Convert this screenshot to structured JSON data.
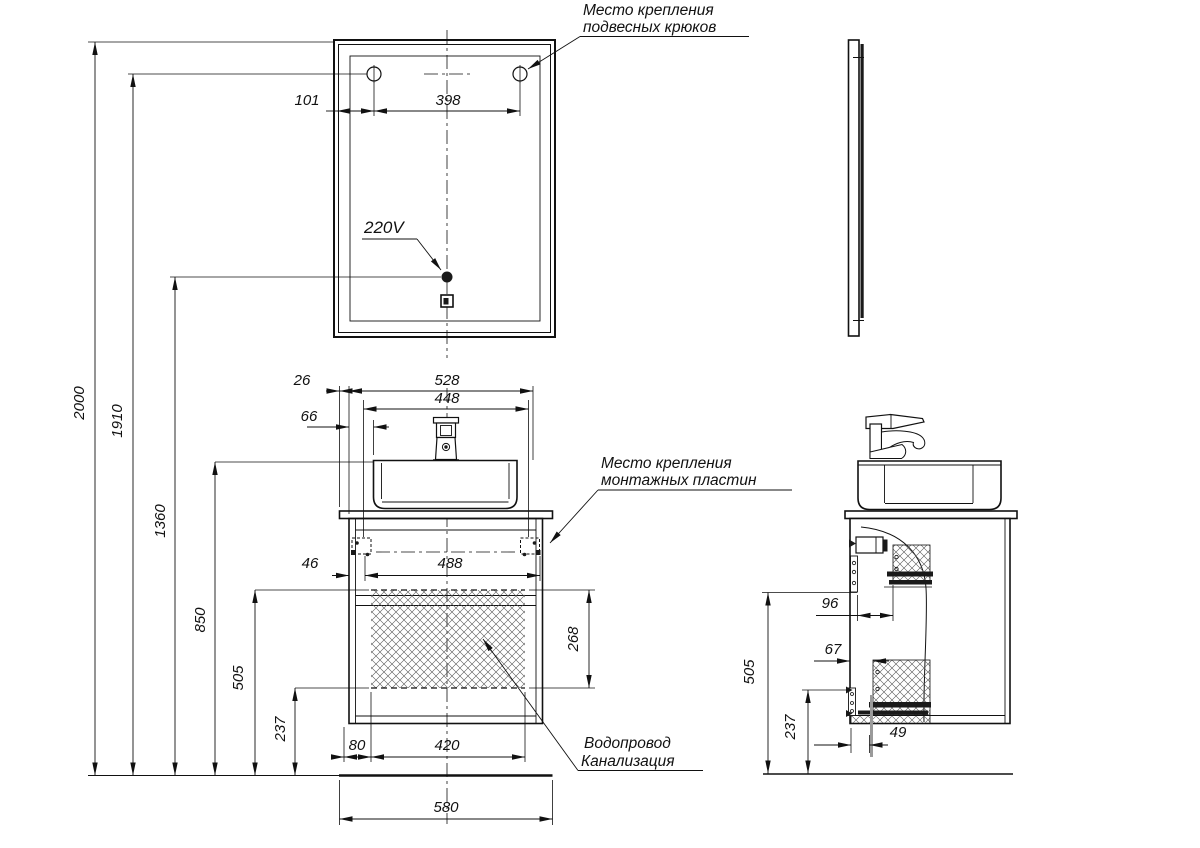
{
  "annotations": {
    "hooks_line1": "Место крепления",
    "hooks_line2": "подвесных крюков",
    "plates_line1": "Место крепления",
    "plates_line2": "монтажных пластин",
    "plumb_line1": "Водопровод",
    "plumb_line2": "Канализация",
    "power": "220V"
  },
  "dims": {
    "d101": "101",
    "d398": "398",
    "d2000": "2000",
    "d1910": "1910",
    "d1360": "1360",
    "d850": "850",
    "d505": "505",
    "d237": "237",
    "d26": "26",
    "d528": "528",
    "d448": "448",
    "d66": "66",
    "d46": "46",
    "d488": "488",
    "d268": "268",
    "d80": "80",
    "d420": "420",
    "d580": "580",
    "d96": "96",
    "d67": "67",
    "d49": "49"
  }
}
